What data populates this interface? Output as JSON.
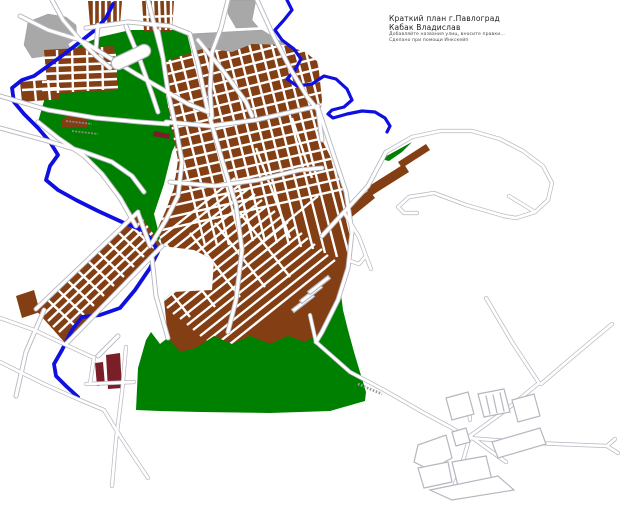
{
  "title_block": {
    "line1": "Краткий план г.Павлоград",
    "line2": "Кабак Владислав",
    "line3": "Добавляйте названия улиц, вносите правки...",
    "line4": "Сделано при помощи Инкскейп"
  },
  "palette": {
    "background": "#ffffff",
    "blocks": "#833f13",
    "park": "#008000",
    "industrial": "#a8a8a8",
    "river": "#0f0fe0",
    "road_fill": "#ffffff",
    "road_casing": "#b6b6c0",
    "special_blocks": "#7a1e28",
    "label_gray": "#8a8a8a"
  }
}
